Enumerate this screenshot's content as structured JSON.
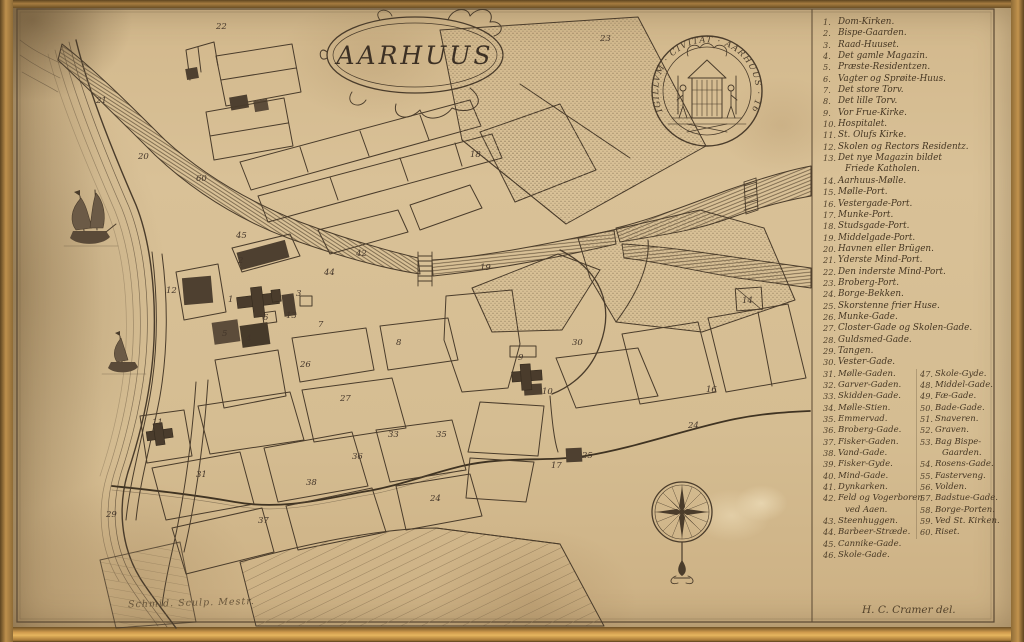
{
  "title_text": "AARHUUS",
  "seal_text": "SIGILLVM · CIVITAT · AARHUUS · 167",
  "signatures": {
    "engraver": "Schmid. Sculp. Mestr.",
    "cartographer": "H. C. Cramer del."
  },
  "colors": {
    "paper": "#d8c096",
    "ink": "#4a3c2b",
    "building_fill": "#4e4030",
    "frame_gold": "#c59a55"
  },
  "legend": {
    "items_top": [
      {
        "num": "1.",
        "label": "Dom-Kirken."
      },
      {
        "num": "2.",
        "label": "Bispe-Gaarden."
      },
      {
        "num": "3.",
        "label": "Raad-Huuset."
      },
      {
        "num": "4.",
        "label": "Det gamle Magazin."
      },
      {
        "num": "5.",
        "label": "Præste-Residentzen."
      },
      {
        "num": "6.",
        "label": "Vagter og Sprøite-Huus."
      },
      {
        "num": "7.",
        "label": "Det store Torv."
      },
      {
        "num": "8.",
        "label": "Det lille Torv."
      },
      {
        "num": "9.",
        "label": "Vor Frue-Kirke."
      },
      {
        "num": "10.",
        "label": "Hospitalet."
      },
      {
        "num": "11.",
        "label": "St. Olufs Kirke."
      },
      {
        "num": "12.",
        "label": "Skolen og Rectors Residentz."
      },
      {
        "num": "13.",
        "label": "Det nye Magazin bildet"
      },
      {
        "num": "",
        "label": "Friede Katholen.",
        "cls": "wrap"
      },
      {
        "num": "14.",
        "label": "Aarhuus-Mølle."
      },
      {
        "num": "15.",
        "label": "Mølle-Port."
      },
      {
        "num": "16.",
        "label": "Vestergade-Port."
      },
      {
        "num": "17.",
        "label": "Munke-Port."
      },
      {
        "num": "18.",
        "label": "Studsgade-Port."
      },
      {
        "num": "19.",
        "label": "Middelgade-Port."
      },
      {
        "num": "20.",
        "label": "Havnen eller Brügen."
      },
      {
        "num": "21.",
        "label": "Yderste Mind-Port."
      },
      {
        "num": "22.",
        "label": "Den inderste Mind-Port."
      },
      {
        "num": "23.",
        "label": "Broberg-Port."
      },
      {
        "num": "24.",
        "label": "Borge-Bekken."
      },
      {
        "num": "25.",
        "label": "Skorstenne frier Huse."
      },
      {
        "num": "26.",
        "label": "Munke-Gade."
      },
      {
        "num": "27.",
        "label": "Closter-Gade og Skolen-Gade."
      },
      {
        "num": "28.",
        "label": "Guldsmed-Gade."
      },
      {
        "num": "29.",
        "label": "Tangen."
      },
      {
        "num": "30.",
        "label": "Vester-Gade."
      }
    ],
    "col_left": [
      {
        "num": "31.",
        "label": "Mølle-Gaden."
      },
      {
        "num": "32.",
        "label": "Garver-Gaden."
      },
      {
        "num": "33.",
        "label": "Skidden-Gade."
      },
      {
        "num": "34.",
        "label": "Mølle-Stien."
      },
      {
        "num": "35.",
        "label": "Emmervad."
      },
      {
        "num": "36.",
        "label": "Broberg-Gade."
      },
      {
        "num": "37.",
        "label": "Fisker-Gaden."
      },
      {
        "num": "38.",
        "label": "Vand-Gade."
      },
      {
        "num": "39.",
        "label": "Fisker-Gyde."
      },
      {
        "num": "40.",
        "label": "Mind-Gade."
      },
      {
        "num": "41.",
        "label": "Dynkarken."
      },
      {
        "num": "42.",
        "label": "Feld og Vogerboren"
      },
      {
        "num": "",
        "label": "ved Aaen.",
        "cls": "wrap"
      },
      {
        "num": "43.",
        "label": "Steenhuggen."
      },
      {
        "num": "44.",
        "label": "Barbeer-Stræde."
      },
      {
        "num": "45.",
        "label": "Cannike-Gade."
      },
      {
        "num": "46.",
        "label": "Skole-Gade."
      }
    ],
    "col_right": [
      {
        "num": "47.",
        "label": "Skole-Gyde."
      },
      {
        "num": "48.",
        "label": "Middel-Gade."
      },
      {
        "num": "49.",
        "label": "Fæ-Gade."
      },
      {
        "num": "50.",
        "label": "Bade-Gade."
      },
      {
        "num": "51.",
        "label": "Snaveren."
      },
      {
        "num": "52.",
        "label": "Graven."
      },
      {
        "num": "53.",
        "label": "Bag Bispe-"
      },
      {
        "num": "",
        "label": "Gaarden.",
        "cls": "wrap"
      },
      {
        "num": "54.",
        "label": "Rosens-Gade."
      },
      {
        "num": "55.",
        "label": "Fasterveng."
      },
      {
        "num": "56.",
        "label": "Volden."
      },
      {
        "num": "57.",
        "label": "Badstue-Gade."
      },
      {
        "num": "58.",
        "label": "Borge-Porten."
      },
      {
        "num": "59.",
        "label": "Ved St. Kirken."
      },
      {
        "num": "60.",
        "label": "Riset."
      }
    ]
  },
  "map_markers": [
    {
      "x": 216,
      "y": 22,
      "label": "22"
    },
    {
      "x": 600,
      "y": 34,
      "label": "23"
    },
    {
      "x": 196,
      "y": 174,
      "label": "60"
    },
    {
      "x": 138,
      "y": 152,
      "label": "20"
    },
    {
      "x": 96,
      "y": 96,
      "label": "21"
    },
    {
      "x": 236,
      "y": 231,
      "label": "45"
    },
    {
      "x": 324,
      "y": 268,
      "label": "44"
    },
    {
      "x": 356,
      "y": 249,
      "label": "42"
    },
    {
      "x": 228,
      "y": 295,
      "label": "1"
    },
    {
      "x": 238,
      "y": 256,
      "label": "2"
    },
    {
      "x": 296,
      "y": 289,
      "label": "3"
    },
    {
      "x": 286,
      "y": 311,
      "label": "13"
    },
    {
      "x": 222,
      "y": 329,
      "label": "5"
    },
    {
      "x": 246,
      "y": 334,
      "label": "4"
    },
    {
      "x": 263,
      "y": 313,
      "label": "6"
    },
    {
      "x": 318,
      "y": 320,
      "label": "7"
    },
    {
      "x": 396,
      "y": 338,
      "label": "8"
    },
    {
      "x": 166,
      "y": 286,
      "label": "12"
    },
    {
      "x": 152,
      "y": 418,
      "label": "11"
    },
    {
      "x": 518,
      "y": 353,
      "label": "9"
    },
    {
      "x": 542,
      "y": 387,
      "label": "10"
    },
    {
      "x": 742,
      "y": 296,
      "label": "14"
    },
    {
      "x": 706,
      "y": 385,
      "label": "16"
    },
    {
      "x": 430,
      "y": 494,
      "label": "24"
    },
    {
      "x": 688,
      "y": 421,
      "label": "24"
    },
    {
      "x": 582,
      "y": 451,
      "label": "25"
    },
    {
      "x": 551,
      "y": 461,
      "label": "17"
    },
    {
      "x": 480,
      "y": 263,
      "label": "19"
    },
    {
      "x": 572,
      "y": 338,
      "label": "30"
    },
    {
      "x": 470,
      "y": 150,
      "label": "18"
    },
    {
      "x": 106,
      "y": 510,
      "label": "29"
    },
    {
      "x": 196,
      "y": 470,
      "label": "31"
    },
    {
      "x": 258,
      "y": 516,
      "label": "37"
    },
    {
      "x": 306,
      "y": 478,
      "label": "38"
    },
    {
      "x": 352,
      "y": 452,
      "label": "36"
    },
    {
      "x": 388,
      "y": 430,
      "label": "33"
    },
    {
      "x": 436,
      "y": 430,
      "label": "35"
    },
    {
      "x": 340,
      "y": 394,
      "label": "27"
    },
    {
      "x": 300,
      "y": 360,
      "label": "26"
    }
  ]
}
